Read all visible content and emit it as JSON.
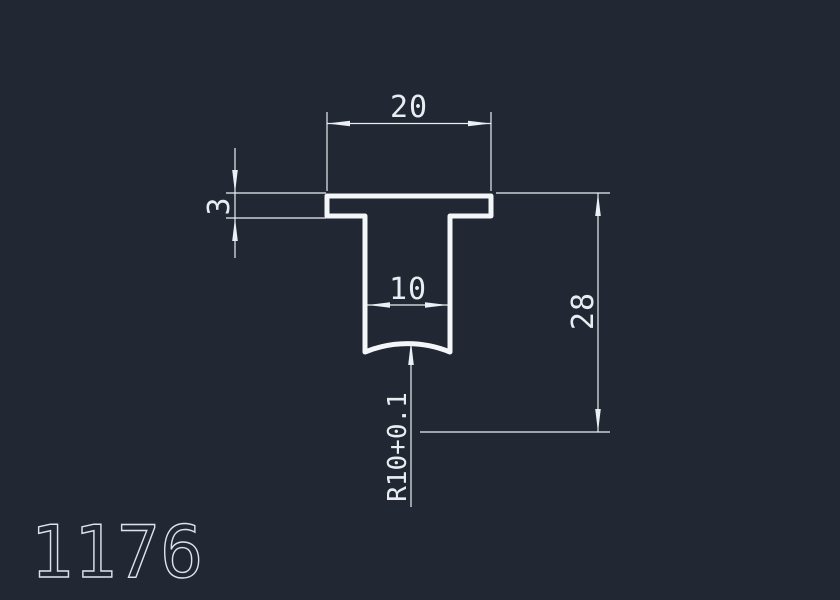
{
  "drawing": {
    "part_number": "1176",
    "colors": {
      "background": "#212733",
      "line": "#f4f6f8",
      "dimension_line": "#eceff3",
      "text": "#e9edf2"
    },
    "profile": {
      "shape": "T-profile cross-section with concave arc bottom"
    },
    "dimensions": {
      "top_width": "20",
      "flange_thickness": "3",
      "stem_width": "10",
      "overall_height": "28",
      "bottom_radius": "R10+0.1"
    }
  }
}
